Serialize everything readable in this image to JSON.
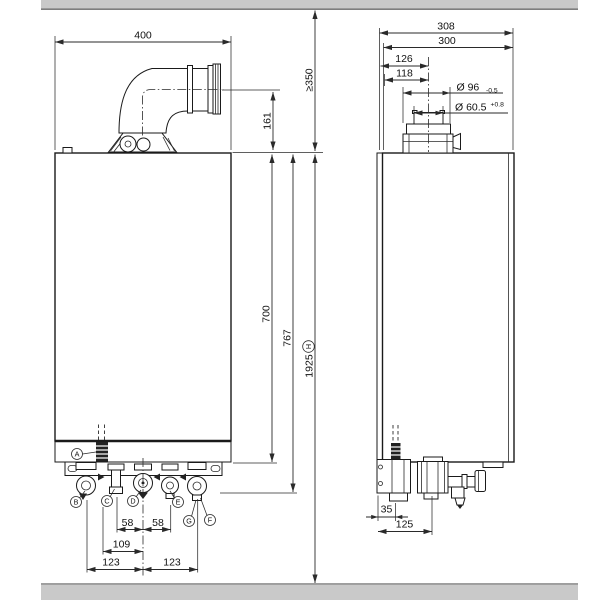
{
  "colors": {
    "line": "#1a1a1a",
    "dimension": "#2a2a2a",
    "slab": "#c9c9c9",
    "slab_edge": "#7e7e7e"
  },
  "front_view": {
    "width": "400",
    "flue_height": "161",
    "clearance_above": "≥350",
    "height_casing": "700",
    "height_connections": "767",
    "height_total": "1925",
    "height_total_ref": "H",
    "spacing_58_left": "58",
    "spacing_58_right": "58",
    "spacing_109": "109",
    "spacing_123_left": "123",
    "spacing_123_right": "123",
    "callouts": {
      "a": "A",
      "b": "B",
      "c": "C",
      "d": "D",
      "e": "E",
      "f": "F",
      "g": "G"
    }
  },
  "side_view": {
    "depth_overall": "308",
    "depth_casing": "300",
    "flue_offset_overall": "126",
    "flue_offset": "118",
    "flue_collar_dia": "Ø 96",
    "flue_collar_tol": "-0.5",
    "flue_pipe_dia": "Ø 60.5",
    "flue_pipe_tol": "+0.8",
    "offset_35": "35",
    "offset_125": "125"
  }
}
